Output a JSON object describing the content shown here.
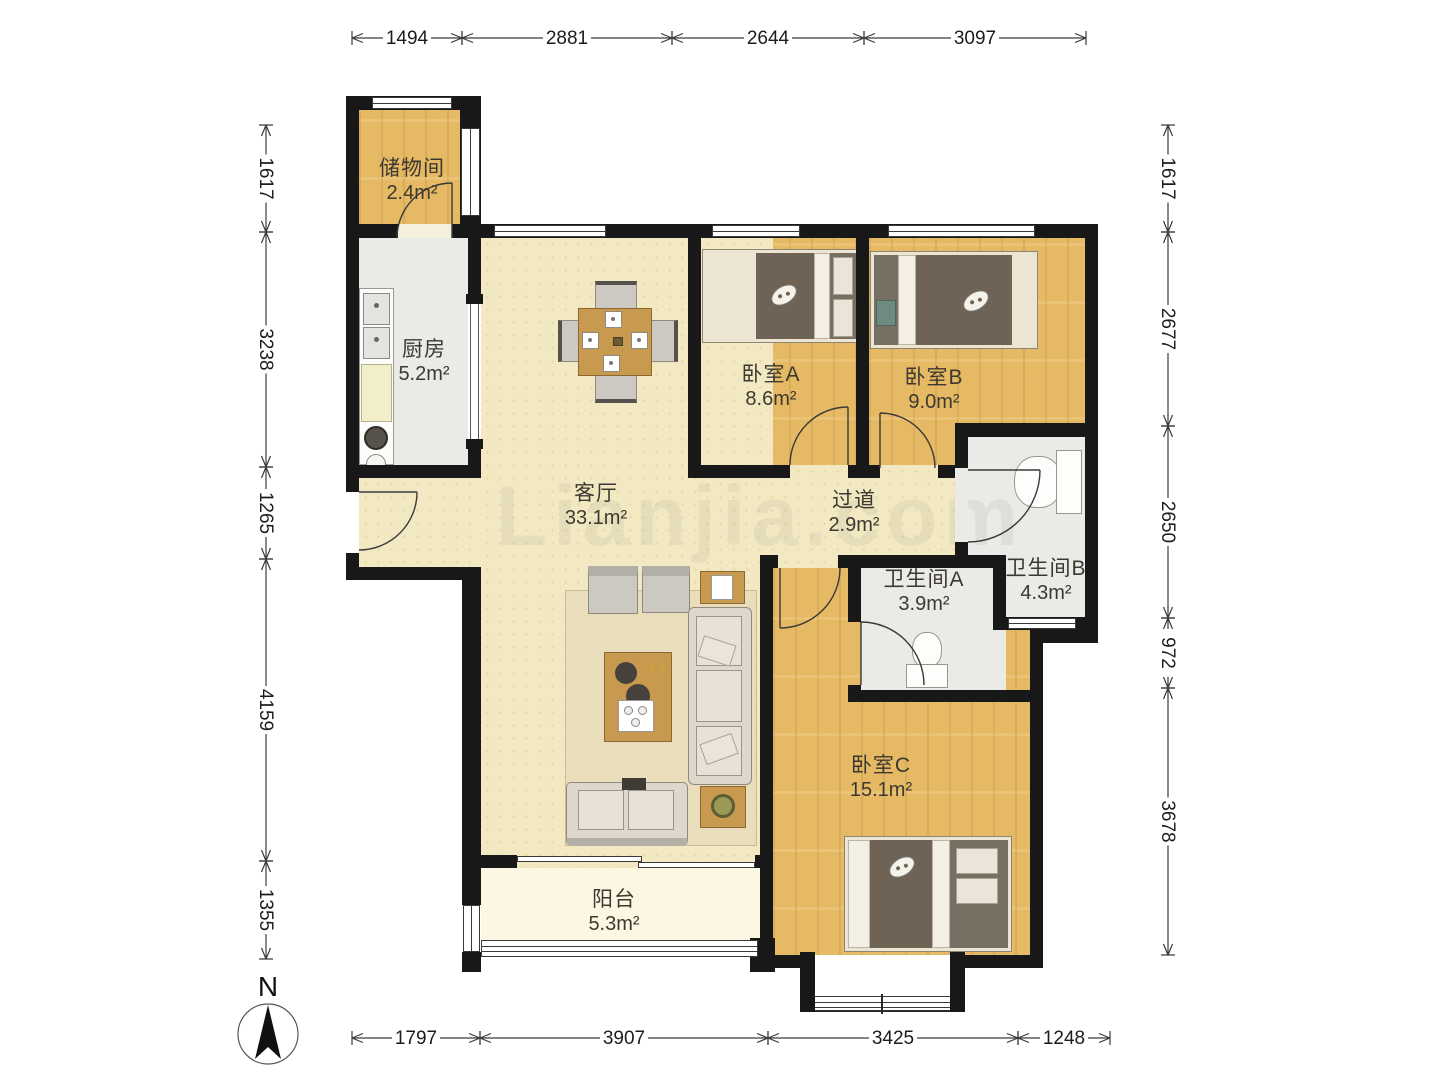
{
  "watermark": "Lianjia.com",
  "compass": {
    "north_label": "N"
  },
  "rooms": [
    {
      "id": "storage",
      "name": "储物间",
      "area": "2.4m²"
    },
    {
      "id": "kitchen",
      "name": "厨房",
      "area": "5.2m²"
    },
    {
      "id": "living",
      "name": "客厅",
      "area": "33.1m²"
    },
    {
      "id": "bedroom-a",
      "name": "卧室A",
      "area": "8.6m²"
    },
    {
      "id": "bedroom-b",
      "name": "卧室B",
      "area": "9.0m²"
    },
    {
      "id": "hallway",
      "name": "过道",
      "area": "2.9m²"
    },
    {
      "id": "bathroom-a",
      "name": "卫生间A",
      "area": "3.9m²"
    },
    {
      "id": "bathroom-b",
      "name": "卫生间B",
      "area": "4.3m²"
    },
    {
      "id": "bedroom-c",
      "name": "卧室C",
      "area": "15.1m²"
    },
    {
      "id": "balcony",
      "name": "阳台",
      "area": "5.3m²"
    }
  ],
  "dimensions": {
    "top": [
      "1494",
      "2881",
      "2644",
      "3097"
    ],
    "bottom": [
      "1797",
      "3907",
      "3425",
      "1248"
    ],
    "left": [
      "1617",
      "3238",
      "1265",
      "4159",
      "1355"
    ],
    "right": [
      "1617",
      "2677",
      "2650",
      "972",
      "3678"
    ]
  },
  "colors": {
    "wall": "#181818",
    "wood_floor": "#e6b964",
    "living_floor": "#f2e9c2",
    "tile_floor": "#eaeae7",
    "balcony_floor": "#fbf7e2",
    "duvet": "#6f6355"
  }
}
